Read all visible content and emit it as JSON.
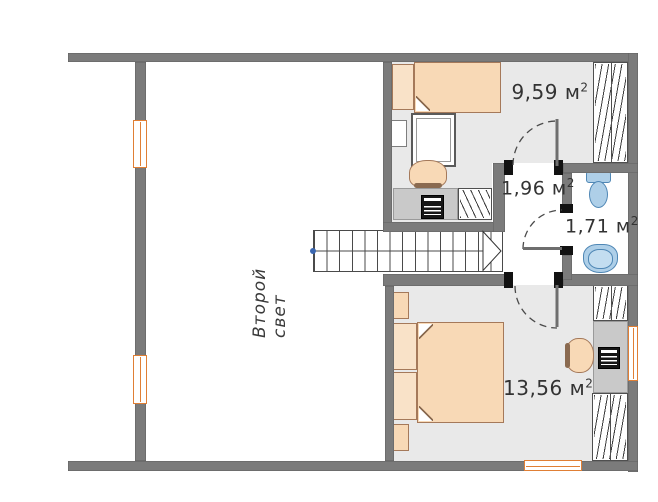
{
  "plan_title": "Второй свет",
  "rooms": {
    "small_bedroom": {
      "area": "9,59"
    },
    "hallway": {
      "area": "1,96"
    },
    "bathroom": {
      "area": "1,71"
    },
    "master_bedroom": {
      "area": "13,56"
    }
  },
  "unit": {
    "base": "м",
    "sup": "2"
  },
  "colors": {
    "wall": "#7b7b7b",
    "floor": "#e9e9e9",
    "window_frame": "#e07f35",
    "furniture_fill": "#f8d9b6",
    "furniture_border": "#a5795a",
    "fixture_fill": "#aecfe8",
    "fixture_border": "#4f87b5",
    "stair_start_dot": "#3a66b0",
    "label_text": "#333333"
  }
}
